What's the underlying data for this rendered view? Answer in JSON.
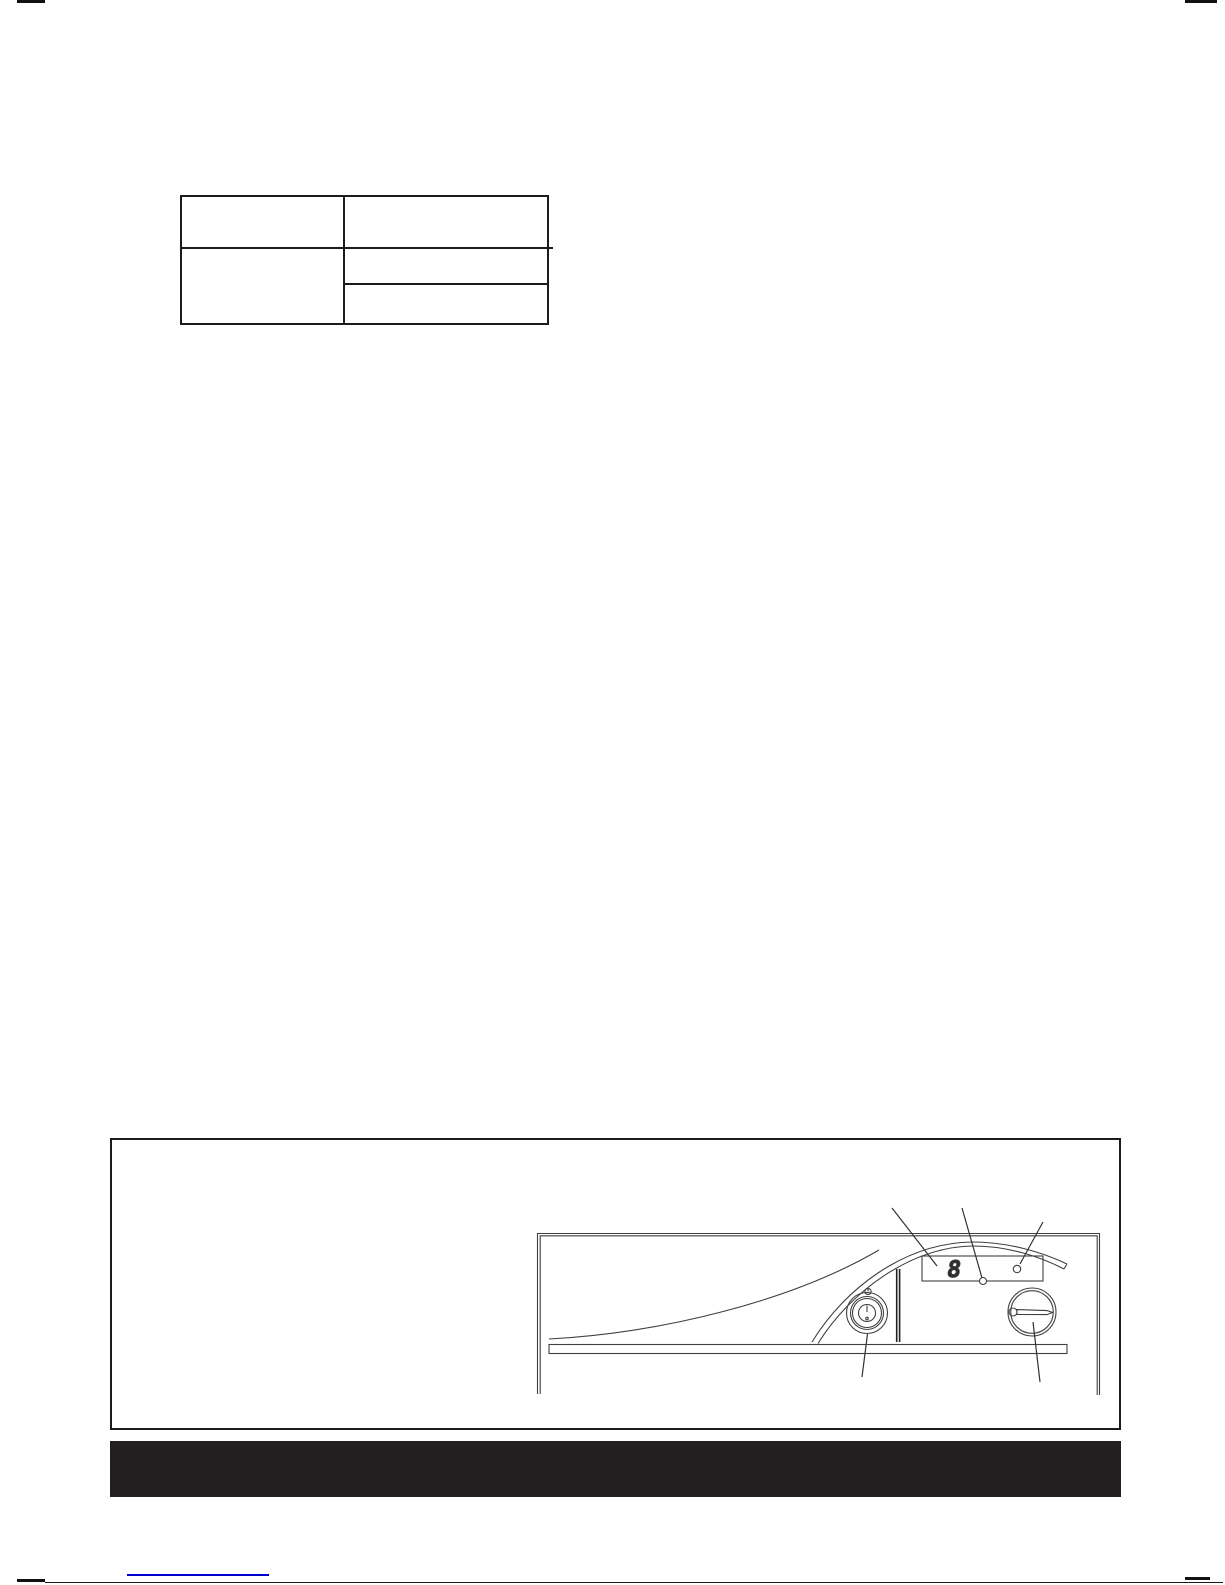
{
  "document": {
    "page_kind": "scanned-manual-page",
    "spec_table": {
      "cells": {
        "r1c1": "",
        "r1c2": "",
        "r2c1": "",
        "r2c2_top": "",
        "r2c2_bottom": ""
      }
    },
    "figure": {
      "content": "control-panel-line-drawing",
      "display_digit": "8",
      "parts": [
        "seven-segment-display",
        "status-led",
        "indicator-lamp",
        "power-button",
        "selector-knob"
      ]
    },
    "footer": {
      "bar_color": "#231f20",
      "link_underline_color": "#0000cd"
    },
    "colors": {
      "line_art": "#3f3f3f",
      "border": "#1b1b1b",
      "page_edge_marks": "#111111"
    }
  }
}
